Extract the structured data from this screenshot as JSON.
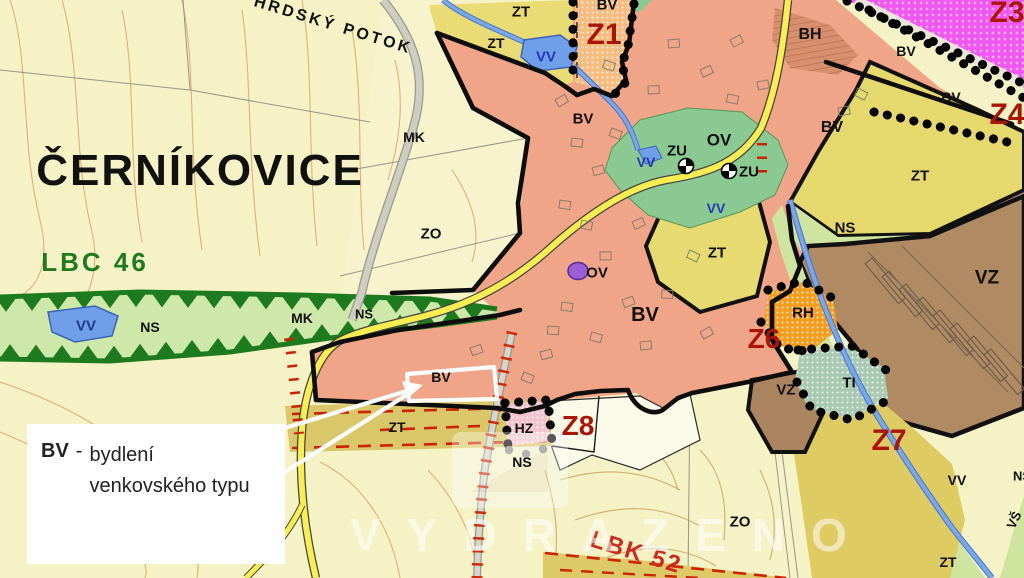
{
  "map": {
    "watermark": "VYDRAZENO",
    "colors": {
      "background": "#f5f2c6",
      "zone_bv_housing": "#f0a488",
      "zone_zt_yellow": "#e8dc72",
      "zone_ns_green": "#cfe49e",
      "zone_vz_brown": "#b08a62",
      "zone_z1_orange_dotted": "#f6bc80",
      "zone_z3_magenta_dotted": "#ee58ee",
      "zone_rh_orange": "#f59d1e",
      "zone_ti_teal": "#a9c9b2",
      "zone_hz_pink": "#f3c3cf",
      "water_blue": "#6f9fe8",
      "road_yellow": "#f8ee52",
      "boundary_black": "#0d0d0d",
      "development_label_red": "#aa1505",
      "biocorridor_green": "#1d7a1d",
      "contour_orange": "#e0a268"
    },
    "labels": [
      {
        "name": "town-name",
        "text": "ČERNÍKOVICE",
        "x": 200,
        "y": 171,
        "size": 44,
        "color": "#111111",
        "spacing": 2
      },
      {
        "name": "stream-name",
        "text": "HRDSKÝ POTOK",
        "x": 333,
        "y": 26,
        "size": 16,
        "color": "#111111",
        "rotate": 17,
        "spacing": 3
      },
      {
        "name": "zone-label-mk",
        "text": "MK",
        "x": 414,
        "y": 137,
        "size": 14,
        "color": "#111111"
      },
      {
        "name": "zone-label-zo",
        "text": "ZO",
        "x": 431,
        "y": 234,
        "size": 15,
        "color": "#111111"
      },
      {
        "name": "zone-label-zt",
        "text": "ZT",
        "x": 521,
        "y": 12,
        "size": 15,
        "color": "#111111"
      },
      {
        "name": "zone-label-zt",
        "text": "ZT",
        "x": 496,
        "y": 43,
        "size": 14,
        "color": "#111111"
      },
      {
        "name": "zone-label-vv",
        "text": "VV",
        "x": 546,
        "y": 57,
        "size": 15,
        "color": "#2438b8"
      },
      {
        "name": "zone-label-bv",
        "text": "BV",
        "x": 607,
        "y": 5,
        "size": 15,
        "color": "#111111"
      },
      {
        "name": "dev-area-label-z1",
        "text": "Z1",
        "x": 604,
        "y": 35,
        "size": 30,
        "color": "#aa1505"
      },
      {
        "name": "zone-label-bh",
        "text": "BH",
        "x": 810,
        "y": 35,
        "size": 16,
        "color": "#111111"
      },
      {
        "name": "zone-label-bv",
        "text": "BV",
        "x": 906,
        "y": 51,
        "size": 14,
        "color": "#111111"
      },
      {
        "name": "zone-label-bv",
        "text": "BV",
        "x": 951,
        "y": 97,
        "size": 14,
        "color": "#111111"
      },
      {
        "name": "dev-area-label-z3",
        "text": "Z3",
        "x": 1007,
        "y": 13,
        "size": 30,
        "color": "#aa1505"
      },
      {
        "name": "dev-area-label-z4",
        "text": "Z4",
        "x": 1007,
        "y": 115,
        "size": 30,
        "color": "#aa1505"
      },
      {
        "name": "zone-label-bv",
        "text": "BV",
        "x": 583,
        "y": 119,
        "size": 15,
        "color": "#111111"
      },
      {
        "name": "zone-label-bv",
        "text": "BV",
        "x": 832,
        "y": 128,
        "size": 16,
        "color": "#111111"
      },
      {
        "name": "zone-label-zt",
        "text": "ZT",
        "x": 920,
        "y": 176,
        "size": 15,
        "color": "#111111"
      },
      {
        "name": "zone-label-ns",
        "text": "NS",
        "x": 845,
        "y": 228,
        "size": 15,
        "color": "#111111"
      },
      {
        "name": "zone-label-vz",
        "text": "VZ",
        "x": 987,
        "y": 278,
        "size": 19,
        "color": "#111111"
      },
      {
        "name": "zone-label-rh",
        "text": "RH",
        "x": 803,
        "y": 313,
        "size": 15,
        "color": "#111111"
      },
      {
        "name": "dev-area-label-z6",
        "text": "Z6",
        "x": 764,
        "y": 339,
        "size": 28,
        "color": "#aa1505"
      },
      {
        "name": "zone-label-ti",
        "text": "TI",
        "x": 849,
        "y": 383,
        "size": 15,
        "color": "#111111"
      },
      {
        "name": "zone-label-vz",
        "text": "VZ",
        "x": 786,
        "y": 390,
        "size": 15,
        "color": "#111111"
      },
      {
        "name": "dev-area-label-z7",
        "text": "Z7",
        "x": 889,
        "y": 441,
        "size": 30,
        "color": "#aa1505"
      },
      {
        "name": "zone-label-ov",
        "text": "OV",
        "x": 719,
        "y": 140,
        "size": 17,
        "color": "#111111"
      },
      {
        "name": "zone-label-zu",
        "text": "ZU",
        "x": 677,
        "y": 151,
        "size": 15,
        "color": "#111111"
      },
      {
        "name": "zone-label-zu",
        "text": "ZU",
        "x": 749,
        "y": 172,
        "size": 15,
        "color": "#111111"
      },
      {
        "name": "zone-label-vv",
        "text": "VV",
        "x": 646,
        "y": 162,
        "size": 14,
        "color": "#2438b8"
      },
      {
        "name": "zone-label-vv",
        "text": "VV",
        "x": 716,
        "y": 208,
        "size": 14,
        "color": "#2438b8"
      },
      {
        "name": "zone-label-ov",
        "text": "OV",
        "x": 597,
        "y": 273,
        "size": 15,
        "color": "#111111"
      },
      {
        "name": "zone-label-bv",
        "text": "BV",
        "x": 645,
        "y": 315,
        "size": 20,
        "color": "#111111"
      },
      {
        "name": "zone-label-zt",
        "text": "ZT",
        "x": 717,
        "y": 253,
        "size": 15,
        "color": "#111111"
      },
      {
        "name": "biocentre-label-lbc46",
        "text": "LBC 46",
        "x": 95,
        "y": 262,
        "size": 26,
        "color": "#1d7a1d",
        "spacing": 3
      },
      {
        "name": "zone-label-vv",
        "text": "VV",
        "x": 86,
        "y": 326,
        "size": 15,
        "color": "#223a8c"
      },
      {
        "name": "zone-label-ns",
        "text": "NS",
        "x": 150,
        "y": 327,
        "size": 14,
        "color": "#111111"
      },
      {
        "name": "zone-label-mk",
        "text": "MK",
        "x": 302,
        "y": 318,
        "size": 14,
        "color": "#111111"
      },
      {
        "name": "zone-label-ns",
        "text": "NS",
        "x": 364,
        "y": 314,
        "size": 13,
        "color": "#111111"
      },
      {
        "name": "zone-label-bv",
        "text": "BV",
        "x": 441,
        "y": 377,
        "size": 14,
        "color": "#111111"
      },
      {
        "name": "zone-label-zt",
        "text": "ZT",
        "x": 397,
        "y": 427,
        "size": 14,
        "color": "#111111"
      },
      {
        "name": "zone-label-hz",
        "text": "HZ",
        "x": 524,
        "y": 428,
        "size": 14,
        "color": "#111111"
      },
      {
        "name": "dev-area-label-z8",
        "text": "Z8",
        "x": 578,
        "y": 426,
        "size": 28,
        "color": "#aa1505"
      },
      {
        "name": "zone-label-ns",
        "text": "NS",
        "x": 522,
        "y": 462,
        "size": 14,
        "color": "#111111"
      },
      {
        "name": "zone-label-zo",
        "text": "ZO",
        "x": 740,
        "y": 522,
        "size": 15,
        "color": "#111111"
      },
      {
        "name": "biocorridor-label-lbk52",
        "text": "LBK 52",
        "x": 636,
        "y": 553,
        "size": 24,
        "color": "#cc2a1e",
        "rotate": 17,
        "spacing": 2
      },
      {
        "name": "zone-label-vv",
        "text": "VV",
        "x": 957,
        "y": 480,
        "size": 14,
        "color": "#111111"
      },
      {
        "name": "zone-label-zt",
        "text": "ZT",
        "x": 948,
        "y": 562,
        "size": 14,
        "color": "#111111"
      },
      {
        "name": "zone-label-vs",
        "text": "VŠ",
        "x": 1014,
        "y": 520,
        "size": 13,
        "color": "#111111",
        "rotate": -65
      },
      {
        "name": "zone-label-ns",
        "text": "NS",
        "x": 1022,
        "y": 476,
        "size": 13,
        "color": "#111111"
      }
    ]
  },
  "legend": {
    "code": "BV",
    "separator": "-",
    "description": "bydlení venkovského typu"
  }
}
